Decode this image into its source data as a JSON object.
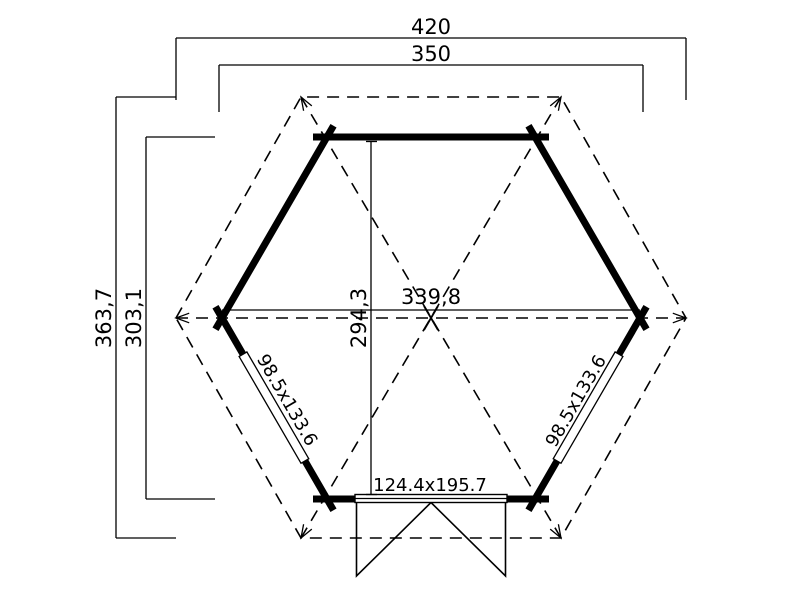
{
  "title": "Hexagonal log cabin floor plan",
  "colors": {
    "ink": "#000000",
    "paper": "#ffffff"
  },
  "dimensions": {
    "roof_width": "420",
    "wall_width": "350",
    "roof_depth": "363,7",
    "wall_depth": "303,1",
    "inner_depth": "294,3",
    "inner_width": "339,8"
  },
  "openings": {
    "window_left": "98.5x133.6",
    "window_right": "98.5x133.6",
    "door": "124.4x195.7"
  }
}
